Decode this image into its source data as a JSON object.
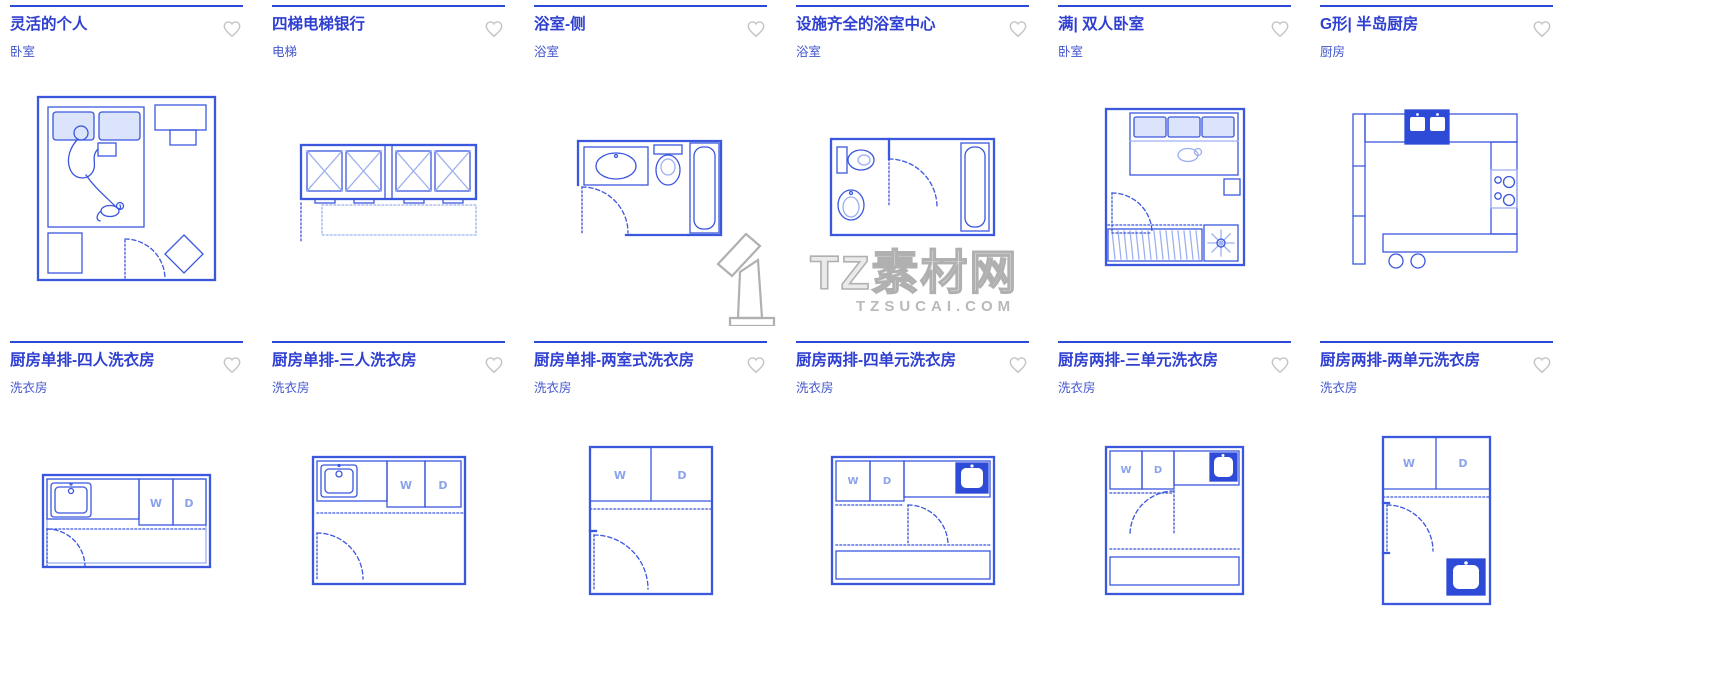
{
  "colors": {
    "accent_blue": "#2e3fd1",
    "category_blue": "#4356cd",
    "drawing_line": "#3b57de",
    "drawing_light": "#9db0f0",
    "heart_gray": "#c4c4c4",
    "watermark_gray": "#b0b0b0"
  },
  "watermark": {
    "brand": "TZ素材网",
    "site": "TZSUCAI.COM"
  },
  "labels": {
    "washer": "W",
    "dryer": "D"
  },
  "cards": [
    {
      "title": "灵活的个人",
      "category": "卧室"
    },
    {
      "title": "四梯电梯银行",
      "category": "电梯"
    },
    {
      "title": "浴室-侧",
      "category": "浴室"
    },
    {
      "title": "设施齐全的浴室中心",
      "category": "浴室"
    },
    {
      "title": "满| 双人卧室",
      "category": "卧室"
    },
    {
      "title": "G形| 半岛厨房",
      "category": "厨房"
    },
    {
      "title": "厨房单排-四人洗衣房",
      "category": "洗衣房"
    },
    {
      "title": "厨房单排-三人洗衣房",
      "category": "洗衣房"
    },
    {
      "title": "厨房单排-两室式洗衣房",
      "category": "洗衣房"
    },
    {
      "title": "厨房两排-四单元洗衣房",
      "category": "洗衣房"
    },
    {
      "title": "厨房两排-三单元洗衣房",
      "category": "洗衣房"
    },
    {
      "title": "厨房两排-两单元洗衣房",
      "category": "洗衣房"
    }
  ]
}
